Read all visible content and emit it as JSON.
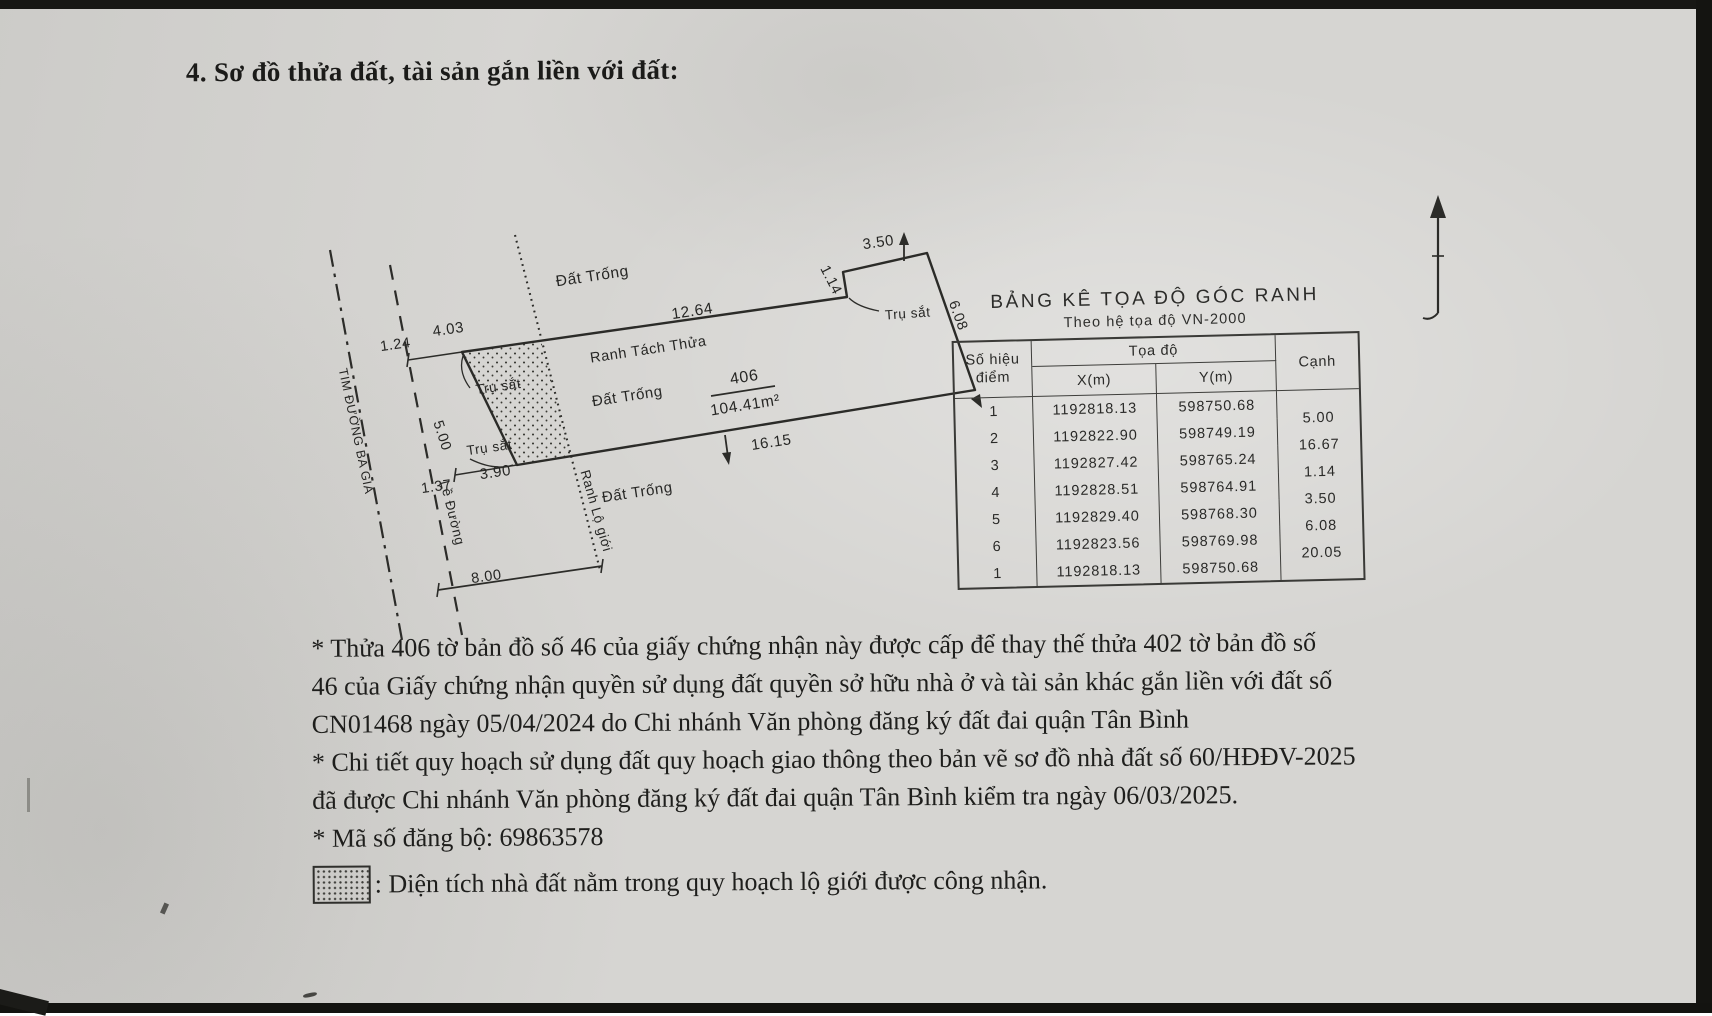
{
  "document": {
    "heading": "4. Sơ đồ thửa đất, tài sản gắn liền với đất:"
  },
  "diagram": {
    "area_labels": {
      "dat_trong_top": "Đất Trống",
      "dat_trong_mid": "Đất Trống",
      "dat_trong_bottom": "Đất Trống"
    },
    "line_labels": {
      "ranh_tach_thua": "Ranh Tách Thửa",
      "ranh_lo_gioi": "Ranh Lộ giới",
      "le_duong": "Lề Đường",
      "tim_duong": "TIM ĐƯỜNG BA GIA"
    },
    "post_labels": {
      "tru_sat_1": "Trụ sắt",
      "tru_sat_2": "Trụ sắt",
      "tru_sat_3": "Trụ sắt"
    },
    "parcel": {
      "number": "406",
      "area": "104.41m²"
    },
    "dimensions": {
      "offset_top": "1.24",
      "top_seg1": "4.03",
      "top_seg2": "12.64",
      "left_edge": "5.00",
      "offset_bottom": "1.37",
      "bottom_seg1": "3.90",
      "bottom_seg2": "16.15",
      "road_width": "8.00",
      "jog": "1.14",
      "top_right": "3.50",
      "right_edge": "6.08"
    }
  },
  "coord_table": {
    "title": "BẢNG KÊ TỌA ĐỘ GÓC RANH",
    "subtitle": "Theo hệ tọa độ VN-2000",
    "headers": {
      "point_line1": "Số hiệu",
      "point_line2": "điểm",
      "coords": "Tọa độ",
      "x": "X(m)",
      "y": "Y(m)",
      "edge": "Cạnh"
    },
    "rows": [
      {
        "point": "1",
        "x": "1192818.13",
        "y": "598750.68"
      },
      {
        "point": "2",
        "x": "1192822.90",
        "y": "598749.19"
      },
      {
        "point": "3",
        "x": "1192827.42",
        "y": "598765.24"
      },
      {
        "point": "4",
        "x": "1192828.51",
        "y": "598764.91"
      },
      {
        "point": "5",
        "x": "1192829.40",
        "y": "598768.30"
      },
      {
        "point": "6",
        "x": "1192823.56",
        "y": "598769.98"
      },
      {
        "point": "1",
        "x": "1192818.13",
        "y": "598750.68"
      }
    ],
    "edge_lengths": [
      "5.00",
      "16.67",
      "1.14",
      "3.50",
      "6.08",
      "20.05"
    ]
  },
  "notes": {
    "lines": [
      "* Thửa 406 tờ bản đồ số 46 của giấy chứng nhận này được cấp để thay thế thửa 402 tờ bản đồ số",
      "46 của Giấy chứng nhận quyền sử dụng đất quyền sở hữu nhà ở và tài sản khác gắn liền với đất số",
      "CN01468 ngày 05/04/2024 do Chi nhánh Văn phòng đăng ký đất đai quận Tân Bình",
      "* Chi tiết quy hoạch sử dụng đất quy hoạch giao thông theo bản vẽ sơ đồ nhà đất số 60/HĐĐV-2025",
      "đã được Chi nhánh Văn phòng đăng ký đất đai quận Tân Bình kiểm tra ngày 06/03/2025.",
      "* Mã số đăng bộ: 69863578"
    ]
  },
  "legend": {
    "text": ": Diện tích nhà đất nằm trong quy hoạch lộ giới được công nhận."
  },
  "colors": {
    "paper": "#d6d5d2",
    "ink": "#262624"
  }
}
